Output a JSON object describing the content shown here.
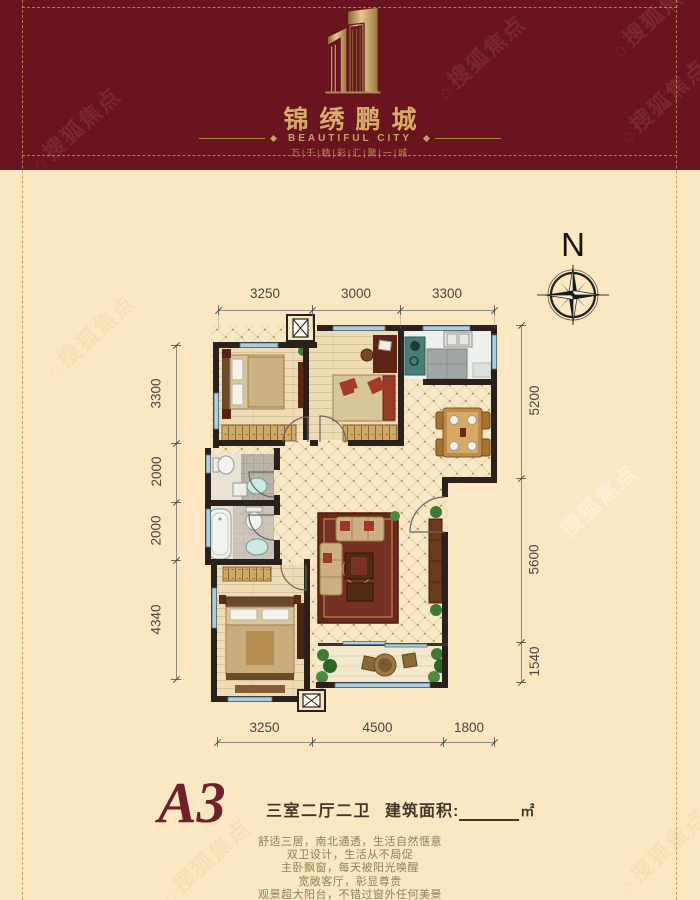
{
  "watermark": {
    "text": "搜狐焦点",
    "house_glyph": "⌂"
  },
  "header": {
    "title": "锦绣鹏城",
    "subtitle": "BEAUTIFUL CITY",
    "tagline": "万|千|精|彩|汇|聚|一|城"
  },
  "compass": {
    "label": "N"
  },
  "dimensions": {
    "top": [
      "3250",
      "3000",
      "3300"
    ],
    "left": [
      "3300",
      "2000",
      "2000",
      "4340"
    ],
    "right": [
      "5200",
      "5600",
      "1540"
    ],
    "bottom": [
      "3250",
      "4500",
      "1800"
    ]
  },
  "unit": {
    "name": "A3",
    "layout": "三室二厅二卫",
    "area_label": "建筑面积:",
    "area_unit": "㎡",
    "features": [
      "舒适三居，南北通透，生活自然惬意",
      "双卫设计，生活从不局促",
      "主卧飘窗，每天被阳光唤醒",
      "宽敞客厅，彰显尊贵",
      "观景超大阳台，不错过窗外任何美景"
    ]
  },
  "colors": {
    "header_bg": "#6A1420",
    "brand_gold": "#C9A464",
    "page_cream": "#FBE7C1",
    "wall": "#2A211C",
    "window_blue": "#A9CFE0",
    "rug_red": "#6B2819",
    "dim_text": "#4A463F",
    "unit_name_red": "#6E2128",
    "feature_text": "#8E8158"
  }
}
